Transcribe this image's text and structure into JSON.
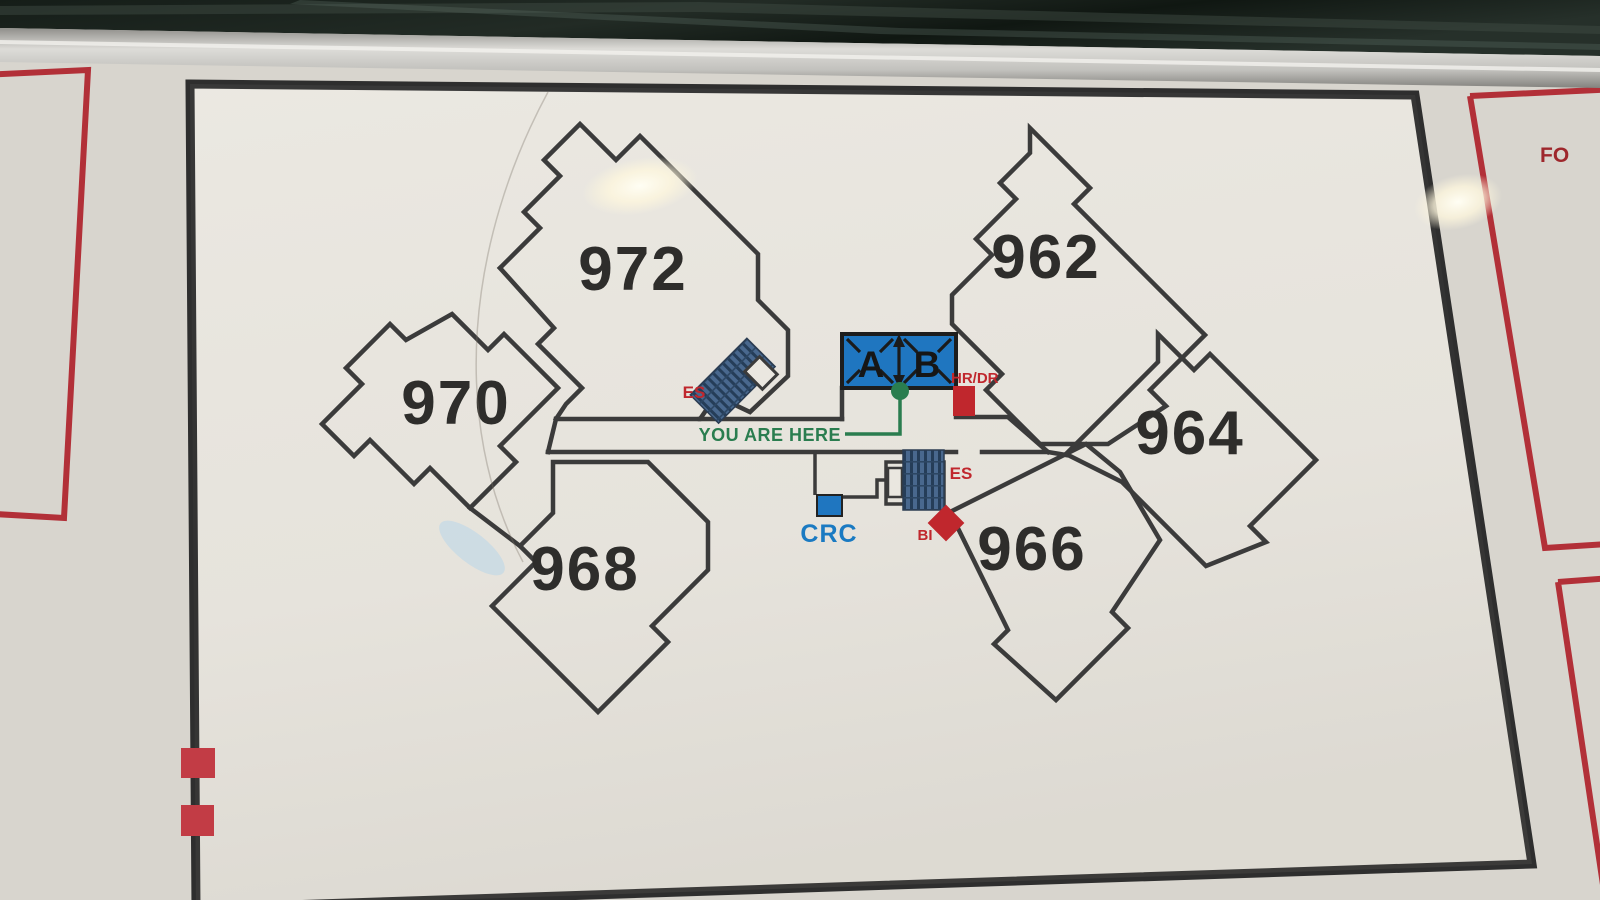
{
  "map_board": {
    "description": "Apartment complex directory site map behind glass",
    "buildings": [
      {
        "label": "972"
      },
      {
        "label": "970"
      },
      {
        "label": "968"
      },
      {
        "label": "962"
      },
      {
        "label": "964"
      },
      {
        "label": "966"
      }
    ],
    "elevator": {
      "car_a": "A",
      "car_b": "B"
    },
    "markers": {
      "you_are_here": "YOU ARE HERE",
      "crc": "CRC",
      "hr_dr": "HR/DR",
      "bi": "BI",
      "es_upper": "ES",
      "es_lower": "ES"
    },
    "right_panel_fragment": "FO",
    "colors": {
      "wall": "#3b3b3b",
      "red": "#c0272d",
      "blue": "#1f76c0",
      "green": "#2a7d4f",
      "stairs_dark": "#253d58",
      "stairs_light": "#49688e",
      "panel_border": "#2e2e2e",
      "red_frame": "#b23038"
    }
  }
}
